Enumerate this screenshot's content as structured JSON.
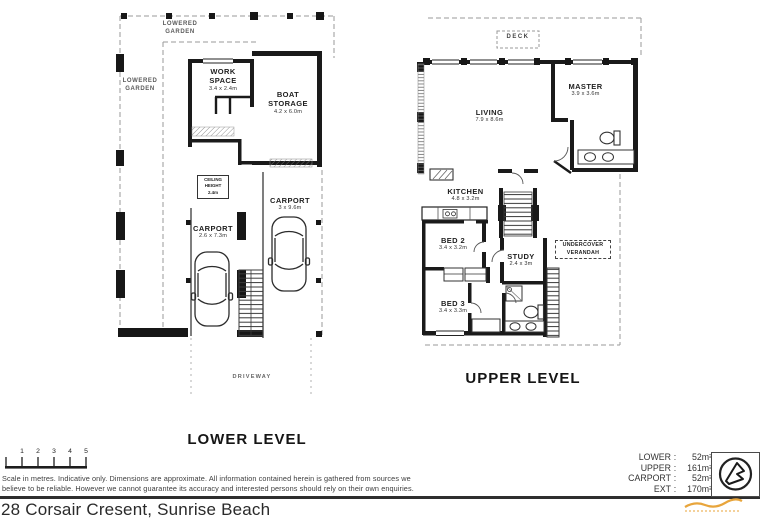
{
  "lower_level": {
    "title": "LOWER LEVEL",
    "garden_top": "LOWERED GARDEN",
    "garden_left": "LOWERED GARDEN",
    "rooms": {
      "work_space": {
        "name": "WORK SPACE",
        "dim": "3.4 x 2.4m"
      },
      "boat_storage": {
        "name": "BOAT STORAGE",
        "dim": "4.2 x 6.0m"
      },
      "carport_left": {
        "name": "CARPORT",
        "dim": "2.6 x 7.3m"
      },
      "carport_right": {
        "name": "CARPORT",
        "dim": "3 x 9.6m"
      }
    },
    "ceiling_note": {
      "name": "CEILING HEIGHT",
      "dim": "2.4m"
    },
    "driveway": "DRIVEWAY"
  },
  "upper_level": {
    "title": "UPPER LEVEL",
    "deck": "DECK",
    "rooms": {
      "living": {
        "name": "LIVING",
        "dim": "7.9 x 8.6m"
      },
      "master": {
        "name": "MASTER",
        "dim": "3.9 x 3.6m"
      },
      "kitchen": {
        "name": "KITCHEN",
        "dim": "4.8 x 3.2m"
      },
      "bed2": {
        "name": "BED 2",
        "dim": "3.4 x 3.2m"
      },
      "study": {
        "name": "STUDY",
        "dim": "2.4 x 3m"
      },
      "bed3": {
        "name": "BED 3",
        "dim": "3.4 x 3.3m"
      }
    },
    "verandah": "UNDERCOVER VERANDAH"
  },
  "footer": {
    "scale_ticks": [
      "1",
      "2",
      "3",
      "4",
      "5"
    ],
    "disclaimer_line1": "Scale in metres. Indicative only. Dimensions  are approximate. All information contained herein is gathered from sources we",
    "disclaimer_line2": "believe to be  reliable. However we cannot guarantee its accuracy and interested persons should  rely on their own enquiries.",
    "address": "28 Corsair Cresent, Sunrise Beach",
    "colon": ":",
    "areas": [
      {
        "label": "LOWER",
        "value": "52m²"
      },
      {
        "label": "UPPER",
        "value": "161m²"
      },
      {
        "label": "CARPORT",
        "value": "52m²"
      },
      {
        "label": "EXT",
        "value": "170m²"
      }
    ]
  }
}
